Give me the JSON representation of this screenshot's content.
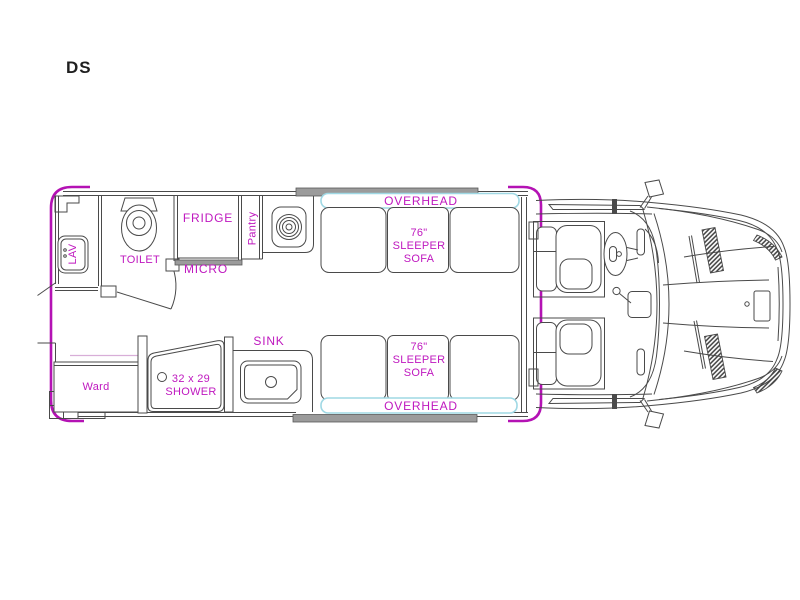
{
  "plan": {
    "code": "DS",
    "labels": {
      "lav": "LAV",
      "toilet": "TOILET",
      "fridge": "FRIDGE",
      "micro": "MICRO",
      "pantry": "Pantry",
      "overhead_top": "OVERHEAD",
      "overhead_bottom": "OVERHEAD",
      "sofa_top": {
        "line1": "76\"",
        "line2": "SLEEPER",
        "line3": "SOFA"
      },
      "sofa_bottom": {
        "line1": "76\"",
        "line2": "SLEEPER",
        "line3": "SOFA"
      },
      "ward": "Ward",
      "shower": {
        "line1": "32 x 29",
        "line2": "SHOWER"
      },
      "sink": "SINK"
    },
    "colors": {
      "body_outline": "#b412b4",
      "label": "#bf18bf",
      "overhead_trim": "#9fd8e4",
      "wall_fill": "#9b9b9b",
      "line": "#4a4a4a",
      "accent_line": "#d8aed8",
      "title_color": "#1f1f1f"
    }
  }
}
